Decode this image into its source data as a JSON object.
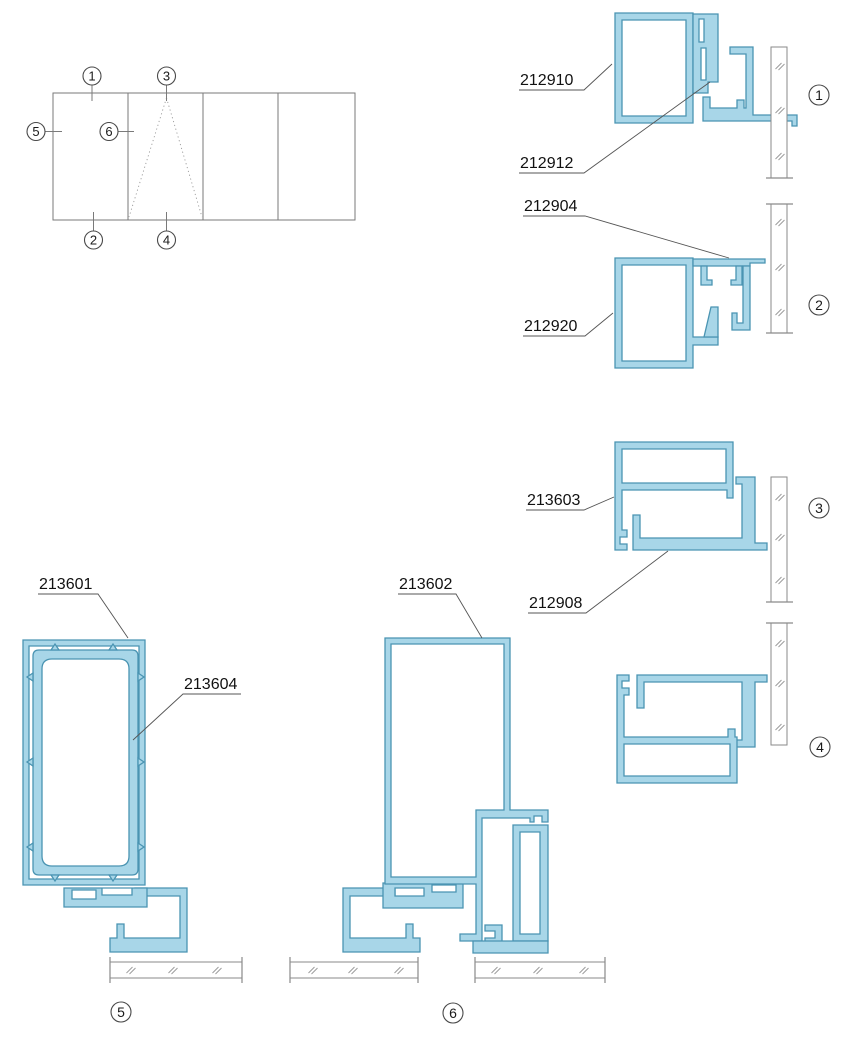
{
  "drawing": {
    "type": "aluminium-window-profile-section-details",
    "colors": {
      "profile_fill": "#A8D6E8",
      "profile_stroke": "#4A94B2",
      "line_gray": "#7A7A7A",
      "text": "#111111"
    }
  },
  "elevation": {
    "callouts": {
      "c1": "1",
      "c2": "2",
      "c3": "3",
      "c4": "4",
      "c5": "5",
      "c6": "6"
    }
  },
  "parts": {
    "s1_frame": "212910",
    "s1_insert": "212912",
    "s2_cap": "212904",
    "s2_frame": "212920",
    "s3_sash": "213603",
    "s3_track": "212908",
    "s5_outer_frame": "213601",
    "s5_inner_profile": "213604",
    "s6_mullion": "213602"
  },
  "section_markers": {
    "m1": "1",
    "m2": "2",
    "m3": "3",
    "m4": "4",
    "m5": "5",
    "m6": "6"
  }
}
